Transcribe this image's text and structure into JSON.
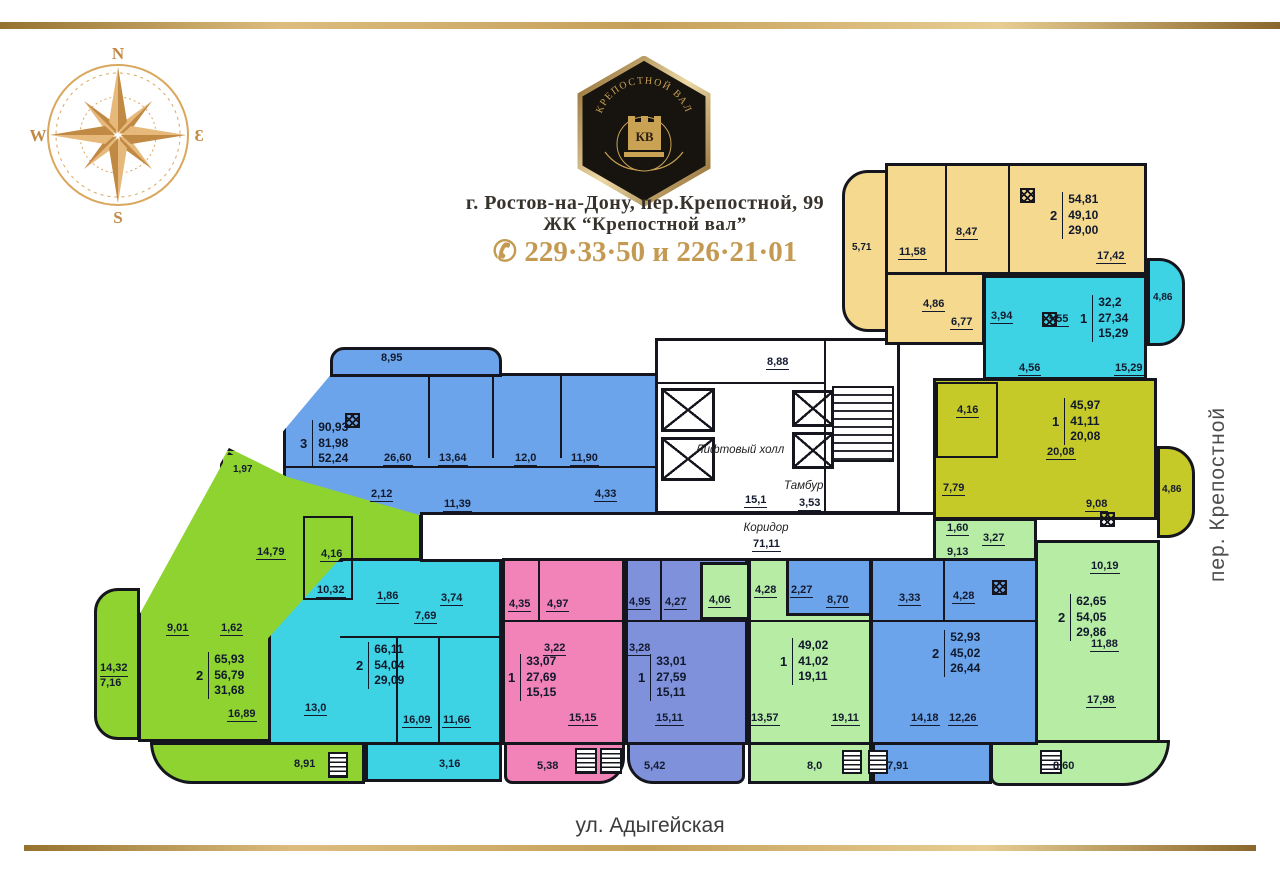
{
  "header": {
    "logo": {
      "arc_text": "КРЕПОСТНОЙ ВАЛ",
      "monogram": "КВ"
    },
    "compass": {
      "north": "N",
      "west": "W",
      "south": "S",
      "east": "Ɛ"
    },
    "address_line1": "г. Ростов-на-Дону, пер.Крепостной, 99",
    "address_line2": "ЖК “Крепостной вал”",
    "phone_icon": "✆",
    "phone": "229·33·50 и 226·21·01"
  },
  "streets": {
    "right_vertical": "пер. Крепостной",
    "bottom": "ул. Адыгейская"
  },
  "common_areas": {
    "lift_hall": "Лифтовый холл",
    "vestibule_area": "8,88",
    "hall_area": "15,1",
    "tambur_label": "Тамбур",
    "tambur_area": "3,53",
    "corridor_label": "Коридор",
    "corridor_area": "71,11"
  },
  "apartments": {
    "yellow_top_right": {
      "count": "2",
      "areas": [
        "54,81",
        "49,10",
        "29,00"
      ],
      "rooms": [
        "11,58",
        "8,47",
        "17,42",
        "4,86",
        "6,77"
      ],
      "balconies": [
        "5,71"
      ]
    },
    "cyan_right": {
      "count": "1",
      "areas": [
        "32,2",
        "27,34",
        "15,29"
      ],
      "rooms": [
        "3,94",
        "3,55",
        "4,56",
        "15,29"
      ],
      "balconies": [
        "4,86"
      ]
    },
    "olive_right": {
      "count": "1",
      "areas": [
        "45,97",
        "41,11",
        "20,08"
      ],
      "rooms": [
        "4,16",
        "7,79",
        "20,08",
        "9,08"
      ],
      "balconies": [
        "4,86"
      ]
    },
    "blue_large": {
      "count": "3",
      "areas": [
        "90,93",
        "81,98",
        "52,24"
      ],
      "rooms": [
        "26,60",
        "13,64",
        "12,0",
        "11,90",
        "2,12",
        "11,39",
        "4,33"
      ],
      "balconies": [
        "8,95"
      ]
    },
    "green_left": {
      "count": "2",
      "areas": [
        "65,93",
        "56,79",
        "31,68"
      ],
      "rooms": [
        "1,97",
        "14,79",
        "4,16",
        "10,32",
        "9,01",
        "1,62",
        "16,89"
      ],
      "balconies": [
        "14,32",
        "7,16",
        "8,91"
      ]
    },
    "cyan_bottom": {
      "count": "2",
      "areas": [
        "66,11",
        "54,04",
        "29,09"
      ],
      "rooms": [
        "1,86",
        "3,74",
        "7,69",
        "13,0",
        "16,09",
        "11,66"
      ],
      "balconies": [
        "3,16"
      ]
    },
    "pink_bottom": {
      "count": "1",
      "areas": [
        "33,07",
        "27,69",
        "15,15"
      ],
      "rooms": [
        "4,35",
        "4,97",
        "3,22",
        "15,15"
      ],
      "balconies": [
        "5,38"
      ]
    },
    "violet_bottom": {
      "count": "1",
      "areas": [
        "33,01",
        "27,59",
        "15,11"
      ],
      "rooms": [
        "4,95",
        "4,27",
        "3,28",
        "15,11"
      ],
      "balconies": [
        "5,42"
      ]
    },
    "lightgreen_bottom": {
      "count": "1",
      "areas": [
        "49,02",
        "41,02",
        "19,11"
      ],
      "rooms": [
        "4,06",
        "4,28",
        "13,57",
        "19,11"
      ],
      "balconies": [
        "8,0"
      ]
    },
    "blue_bottom_right": {
      "count": "2",
      "areas": [
        "52,93",
        "45,02",
        "26,44"
      ],
      "rooms": [
        "2,27",
        "8,70",
        "3,33",
        "4,28",
        "14,18",
        "12,26"
      ],
      "balconies": [
        "7,91"
      ]
    },
    "lightgreen_right": {
      "count": "2",
      "areas": [
        "62,65",
        "54,05",
        "29,86"
      ],
      "rooms": [
        "1,60",
        "3,27",
        "9,13",
        "10,19",
        "11,88",
        "17,98"
      ],
      "balconies": [
        "8,60"
      ]
    }
  },
  "colors": {
    "gold": "#c49a52",
    "yellow": "#f5d98e",
    "cyan": "#3ed3e4",
    "olive": "#c6ca28",
    "blue": "#6ba4ea",
    "violet": "#8091dc",
    "green": "#8fd331",
    "lightgreen": "#b6eca4",
    "pink": "#f183b8",
    "walls": "#15151d"
  }
}
